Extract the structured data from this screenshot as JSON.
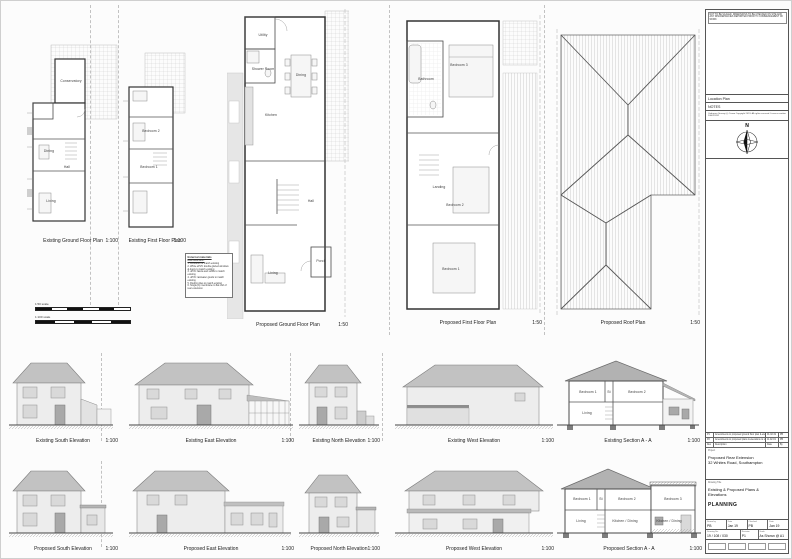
{
  "figures": {
    "plans": [
      {
        "caption": "Existing Ground Floor Plan",
        "scale": "1:100",
        "rooms": {
          "conservatory": "Conservatory",
          "dining": "Dining",
          "hall": "Hall",
          "living": "Living"
        }
      },
      {
        "caption": "Existing First Floor Plan",
        "scale": "1:100",
        "rooms": {
          "bedroom2": "Bedroom 2",
          "bedroom1": "Bedroom 1"
        }
      },
      {
        "caption": "Proposed Ground Floor Plan",
        "scale": "1:50",
        "rooms": {
          "utility": "Utility",
          "shower": "Shower Room",
          "kitchen": "Kitchen",
          "dining": "Dining",
          "hall": "Hall",
          "living": "Living",
          "porch": "Porch"
        }
      },
      {
        "caption": "Proposed First Floor Plan",
        "scale": "1:50",
        "rooms": {
          "bedroom3": "Bedroom 3",
          "bathroom": "Bathroom",
          "landing": "Landing",
          "bedroom2": "Bedroom 2",
          "bedroom1": "Bedroom 1"
        }
      },
      {
        "caption": "Proposed Roof Plan",
        "scale": "1:50"
      }
    ],
    "existing_elevations": [
      {
        "caption": "Existing South Elevation",
        "scale": "1:100"
      },
      {
        "caption": "Existing East Elevation",
        "scale": "1:100"
      },
      {
        "caption": "Existing North Elevation",
        "scale": "1:100"
      },
      {
        "caption": "Existing West Elevation",
        "scale": "1:100"
      },
      {
        "caption": "Existing Section A - A",
        "scale": "1:100",
        "rooms": {
          "bedroom1": "Bedroom 1",
          "st": "St",
          "bedroom2": "Bedroom 2",
          "living": "Living"
        }
      }
    ],
    "proposed_elevations": [
      {
        "caption": "Proposed South Elevation",
        "scale": "1:100"
      },
      {
        "caption": "Proposed East Elevation",
        "scale": "1:100"
      },
      {
        "caption": "Proposed North Elevation",
        "scale": "1:100"
      },
      {
        "caption": "Proposed West Elevation",
        "scale": "1:100"
      },
      {
        "caption": "Proposed Section A - A",
        "scale": "1:100",
        "rooms": {
          "bedroom1": "Bedroom 1",
          "st": "St",
          "bedroom2": "Bedroom 2",
          "bedroom3": "Bedroom 3",
          "living": "Living",
          "kitchen_dining": "Kitchen / Dining"
        }
      }
    ]
  },
  "materials": {
    "title": "External materials",
    "subtitle": "Rear Extension:",
    "items": [
      "1. Brickwork to match existing",
      "2. White uPVC double glazed windows & doors to match existing",
      "3. uPVC fascia and soffits to match existing",
      "4. uPVC rainwater goods to match existing",
      "5. Roofing tiles to match existing",
      "6. Single ply membrane to flat roof of rear extension"
    ]
  },
  "scale_bars": {
    "b50": "1:50 scale",
    "b100": "1:100 scale"
  },
  "title_block": {
    "disclaimer": "NOT TO BE SCALED. DIMENSIONS TO BE CHECKED ON SITE AND ANY DISCREPANCIES REPORTED PRIOR TO COMMENCEMENT OF WORK",
    "location_plan_label": "Location Plan",
    "notes_label": "NOTES",
    "os_copyright": "Ordnance Survey (c) Crown Copyright 2019. All rights reserved. Licence number 100022432",
    "north_label": "N",
    "revisions": [
      {
        "rev": "P1",
        "desc": "Amendments to proposed ground floor plan & elevations",
        "date": "01.02.19",
        "by": "PB"
      },
      {
        "rev": "P2",
        "desc": "Amendments to proposed plans & elevations to suit",
        "date": "11.02.19",
        "by": "PB"
      }
    ],
    "revision_header": {
      "rev": "Rev",
      "desc": "Description",
      "date": "Date",
      "by": "By"
    },
    "project_label": "Project",
    "project_line1": "Proposed Rear Extension",
    "project_line2": "32 Whites Road, Southampton",
    "drawing_title_label": "Drawing Title",
    "drawing_title_line1": "Existing & Proposed Plans & Elevations",
    "status": "PLANNING",
    "drawn_label": "Drawn by",
    "drawn_value": "PB",
    "drawn_date_label": "Date",
    "drawn_date": "Jan 19",
    "checked_label": "Checked",
    "checked_value": "PB",
    "checked_date_label": "Date",
    "checked_date": "Jan 19",
    "drawing_no_label": "Drawing No.",
    "drawing_no": "19 / 108 / 030",
    "revision_label": "Revision",
    "revision_value": "P1",
    "scale_label": "Scale",
    "scale_value": "As Shown @ A1"
  }
}
